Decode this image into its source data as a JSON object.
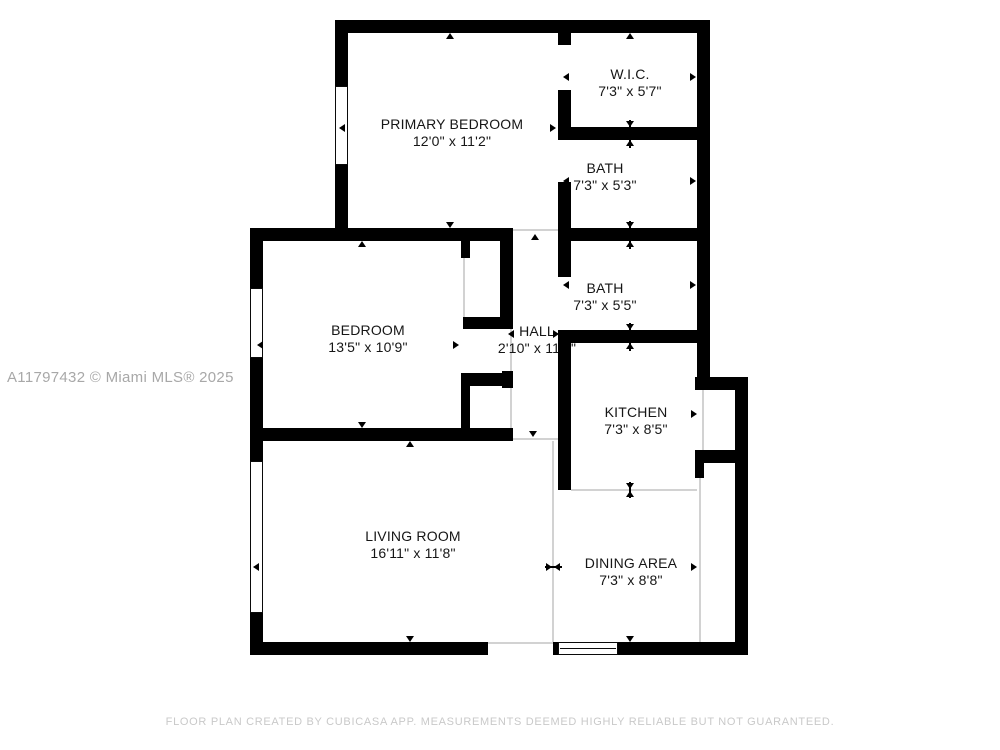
{
  "floor_plan": {
    "wall_color": "#000000",
    "text_color": "#161616",
    "watermark": {
      "text": "A11797432 © Miami MLS® 2025"
    },
    "footer": {
      "text": "FLOOR PLAN CREATED BY CUBICASA APP. MEASUREMENTS DEEMED HIGHLY RELIABLE BUT NOT GUARANTEED."
    },
    "rooms": [
      {
        "id": "primary-bedroom",
        "name": "PRIMARY BEDROOM",
        "dims": "12'0\" x 11'2\"",
        "cx": 452,
        "cy": 133
      },
      {
        "id": "wic",
        "name": "W.I.C.",
        "dims": "7'3\" x 5'7\"",
        "cx": 630,
        "cy": 83
      },
      {
        "id": "bath-upper",
        "name": "BATH",
        "dims": "7'3\" x 5'3\"",
        "cx": 605,
        "cy": 177
      },
      {
        "id": "bath-lower",
        "name": "BATH",
        "dims": "7'3\" x 5'5\"",
        "cx": 605,
        "cy": 297
      },
      {
        "id": "bedroom",
        "name": "BEDROOM",
        "dims": "13'5\" x 10'9\"",
        "cx": 368,
        "cy": 339
      },
      {
        "id": "hall",
        "name": "HALL",
        "dims": "2'10\" x 11'2\"",
        "cx": 537,
        "cy": 340
      },
      {
        "id": "kitchen",
        "name": "KITCHEN",
        "dims": "7'3\" x 8'5\"",
        "cx": 636,
        "cy": 421
      },
      {
        "id": "living-room",
        "name": "LIVING ROOM",
        "dims": "16'11\" x 11'8\"",
        "cx": 413,
        "cy": 545
      },
      {
        "id": "dining-area",
        "name": "DINING AREA",
        "dims": "7'3\" x 8'8\"",
        "cx": 631,
        "cy": 572
      }
    ],
    "walls": [
      [
        335,
        20,
        375,
        13
      ],
      [
        335,
        20,
        13,
        70
      ],
      [
        335,
        163,
        13,
        78
      ],
      [
        697,
        20,
        13,
        370
      ],
      [
        558,
        27,
        13,
        18
      ],
      [
        558,
        90,
        13,
        47
      ],
      [
        558,
        182,
        13,
        59
      ],
      [
        558,
        127,
        152,
        13
      ],
      [
        250,
        228,
        263,
        13
      ],
      [
        558,
        228,
        152,
        13
      ],
      [
        250,
        228,
        13,
        62
      ],
      [
        250,
        356,
        13,
        107
      ],
      [
        250,
        611,
        13,
        44
      ],
      [
        250,
        642,
        238,
        13
      ],
      [
        617,
        642,
        131,
        13
      ],
      [
        735,
        377,
        13,
        278
      ],
      [
        695,
        377,
        53,
        13
      ],
      [
        695,
        450,
        53,
        13
      ],
      [
        695,
        463,
        9,
        15
      ],
      [
        558,
        330,
        152,
        13
      ],
      [
        558,
        330,
        13,
        160
      ],
      [
        558,
        241,
        13,
        36
      ],
      [
        500,
        232,
        13,
        95
      ],
      [
        463,
        317,
        50,
        12
      ],
      [
        461,
        241,
        9,
        17
      ],
      [
        461,
        373,
        52,
        13
      ],
      [
        461,
        373,
        9,
        60
      ],
      [
        250,
        428,
        263,
        13
      ],
      [
        502,
        371,
        11,
        17
      ],
      [
        553,
        642,
        6,
        13
      ]
    ],
    "windows": [
      {
        "x": 335,
        "y": 86,
        "w": 13,
        "h": 79,
        "orient": "v"
      },
      {
        "x": 250,
        "y": 288,
        "w": 13,
        "h": 70,
        "orient": "v"
      },
      {
        "x": 250,
        "y": 461,
        "w": 13,
        "h": 152,
        "orient": "v"
      },
      {
        "x": 558,
        "y": 642,
        "w": 60,
        "h": 13,
        "orient": "h"
      }
    ],
    "area_lines": [
      [
        513,
        229,
        45,
        2
      ],
      [
        513,
        438,
        45,
        2
      ],
      [
        552,
        441,
        2,
        201
      ],
      [
        571,
        489,
        126,
        2
      ],
      [
        699,
        463,
        2,
        179
      ],
      [
        488,
        642,
        65,
        2
      ],
      [
        463,
        258,
        2,
        59
      ],
      [
        702,
        390,
        2,
        60
      ],
      [
        510,
        327,
        2,
        101
      ]
    ],
    "markers": [
      [
        450,
        36,
        "up"
      ],
      [
        342,
        128,
        "left"
      ],
      [
        553,
        128,
        "right"
      ],
      [
        450,
        225,
        "down"
      ],
      [
        630,
        36,
        "up"
      ],
      [
        566,
        77,
        "left"
      ],
      [
        693,
        77,
        "right"
      ],
      [
        630,
        124,
        "down"
      ],
      [
        630,
        143,
        "up"
      ],
      [
        566,
        181,
        "left"
      ],
      [
        693,
        181,
        "right"
      ],
      [
        630,
        225,
        "down"
      ],
      [
        630,
        244,
        "up"
      ],
      [
        566,
        285,
        "left"
      ],
      [
        693,
        285,
        "right"
      ],
      [
        630,
        327,
        "down"
      ],
      [
        630,
        346,
        "up"
      ],
      [
        567,
        414,
        "left"
      ],
      [
        694,
        414,
        "right"
      ],
      [
        630,
        486,
        "down"
      ],
      [
        630,
        494,
        "up"
      ],
      [
        557,
        567,
        "left"
      ],
      [
        694,
        567,
        "right"
      ],
      [
        630,
        639,
        "down"
      ],
      [
        362,
        244,
        "up"
      ],
      [
        260,
        345,
        "left"
      ],
      [
        456,
        345,
        "right"
      ],
      [
        362,
        425,
        "down"
      ],
      [
        535,
        237,
        "up"
      ],
      [
        511,
        334,
        "left"
      ],
      [
        556,
        334,
        "right"
      ],
      [
        533,
        434,
        "down"
      ],
      [
        410,
        444,
        "up"
      ],
      [
        256,
        567,
        "left"
      ],
      [
        549,
        567,
        "right"
      ],
      [
        410,
        639,
        "down"
      ]
    ],
    "marker_lines": [
      [
        629,
        120,
        2,
        28
      ],
      [
        629,
        221,
        2,
        28
      ],
      [
        629,
        323,
        2,
        28
      ],
      [
        629,
        482,
        2,
        16
      ],
      [
        545,
        566,
        17,
        2
      ]
    ]
  }
}
